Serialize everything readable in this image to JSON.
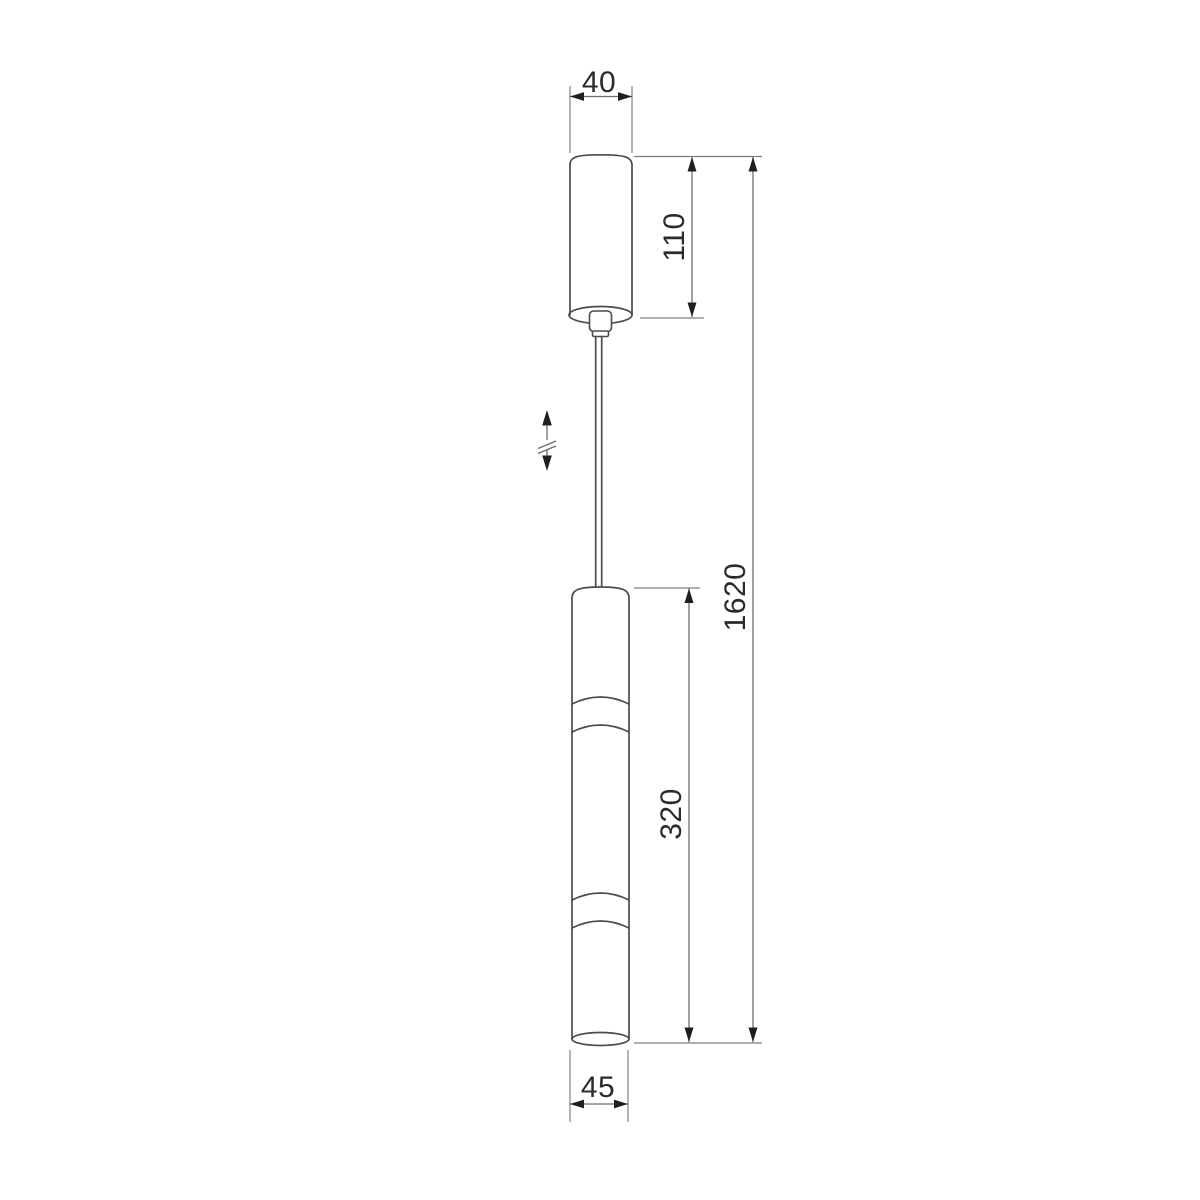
{
  "page": {
    "background_color": "#ffffff"
  },
  "drawing": {
    "kind": "pendant-lamp-dimension-drawing",
    "colors": {
      "object_line": "#4c4c4c",
      "dimension_line": "#6d6d6d",
      "arrow": "#1f1f1f",
      "label_text": "#2b2b2b"
    },
    "dimensions": {
      "canopy_width": "40",
      "canopy_height": "110",
      "overall_length": "1620",
      "body_length": "320",
      "body_width": "45"
    },
    "symbols": {
      "height_adjustable_icon": "vertical-double-arrow-with-break"
    }
  }
}
